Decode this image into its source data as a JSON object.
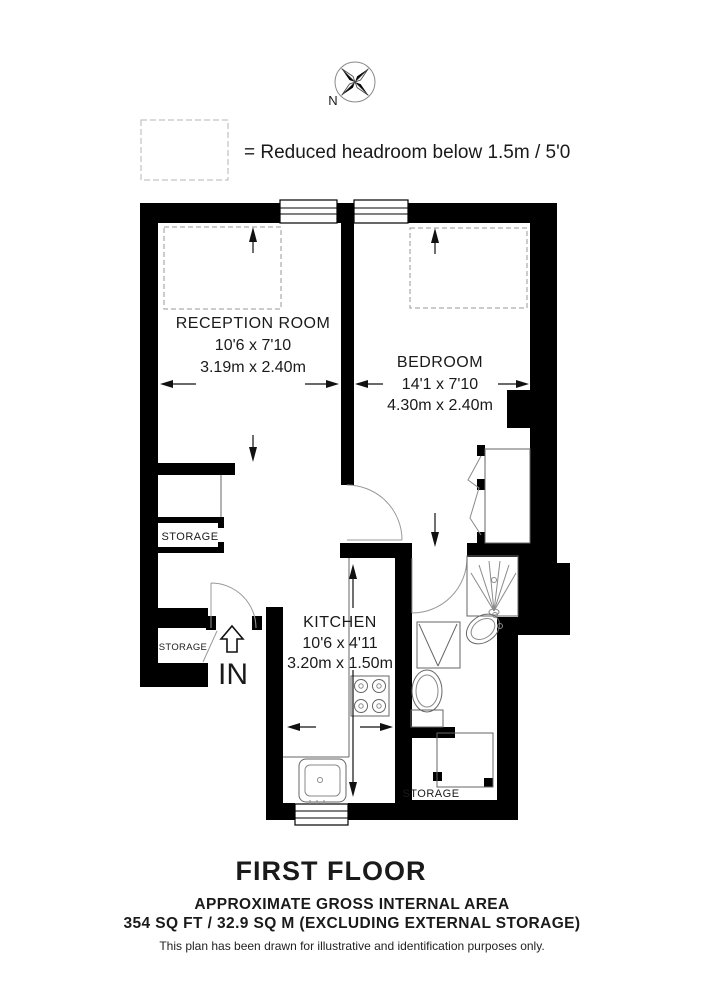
{
  "colors": {
    "background": "#ffffff",
    "wall": "#000000",
    "fixture_line": "#666666",
    "door_arc": "#999999",
    "dashed_line": "#9a9a9a"
  },
  "compass": {
    "label": "N"
  },
  "legend": {
    "text": "= Reduced headroom below 1.5m / 5'0"
  },
  "rooms": {
    "reception": {
      "name": "RECEPTION ROOM",
      "imperial": "10'6 x 7'10",
      "metric": "3.19m x 2.40m"
    },
    "bedroom": {
      "name": "BEDROOM",
      "imperial": "14'1 x 7'10",
      "metric": "4.30m x 2.40m"
    },
    "kitchen": {
      "name": "KITCHEN",
      "imperial": "10'6 x 4'11",
      "metric": "3.20m x 1.50m"
    }
  },
  "storage": {
    "upper": "STORAGE",
    "entry": "STORAGE",
    "external": "STORAGE"
  },
  "entrance": {
    "label": "IN"
  },
  "footer": {
    "floor_title": "FIRST FLOOR",
    "area_heading": "APPROXIMATE GROSS INTERNAL AREA",
    "area_detail": "354 SQ FT / 32.9 SQ M (EXCLUDING EXTERNAL STORAGE)",
    "disclaimer": "This plan has been drawn for illustrative and identification purposes only."
  }
}
